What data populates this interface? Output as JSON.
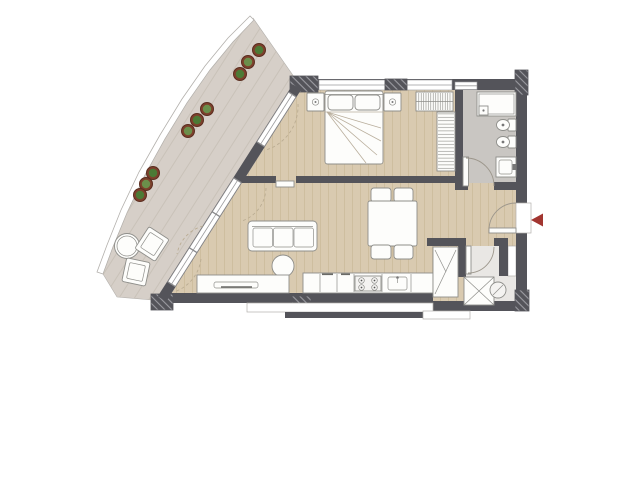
{
  "plan": {
    "type": "apartment-floor-plan",
    "rooms": [
      {
        "name": "terrace",
        "furniture": [
          "round-outdoor-table",
          "lounge-chair",
          "lounge-chair"
        ],
        "planter_count": 9
      },
      {
        "name": "bedroom",
        "furniture": [
          "double-bed",
          "nightstand-with-lamp",
          "nightstand-with-lamp",
          "wardrobe-hanging-rail",
          "wardrobe-shelf-column"
        ]
      },
      {
        "name": "bathroom",
        "fixtures": [
          "shower",
          "toilet",
          "bidet",
          "washbasin-cabinet"
        ]
      },
      {
        "name": "living-dining",
        "furniture": [
          "three-seat-sofa",
          "round-coffee-table",
          "sideboard",
          "dining-table",
          "dining-chair",
          "dining-chair",
          "dining-chair",
          "dining-chair"
        ]
      },
      {
        "name": "kitchen",
        "fixtures": [
          "counter-run",
          "cooktop-4-burners",
          "kitchen-sink"
        ]
      },
      {
        "name": "utility-room",
        "fixtures": [
          "washing-machine",
          "boiler",
          "shelf-closet",
          "shaft"
        ]
      },
      {
        "name": "entry-hall",
        "fixtures": [
          "entry-door",
          "bathroom-door",
          "utility-door",
          "sliding-bedroom-door"
        ]
      }
    ],
    "entry_marker": "red-arrow-pointing-left"
  },
  "colors": {
    "wall": "#54545a",
    "wallHatchLine": "#9b9ba1",
    "wood": "#d9cab0",
    "woodLine": "#c8b796",
    "terrace": "#d6cfc8",
    "terraceLine": "#c3bbb2",
    "bath": "#c9c6c2",
    "utility": "#e9e7e4",
    "outline": "#8e8e8a",
    "furnitureFill": "#fdfdfb",
    "glassLine": "#9a9a9c",
    "curbLine": "#b3b0ac",
    "dashArc": "#b9ab91",
    "accent": "#a23530",
    "plantPot": "#7d402c",
    "plantGreenA": "#4c7a35",
    "plantGreenB": "#6b8f4b"
  }
}
